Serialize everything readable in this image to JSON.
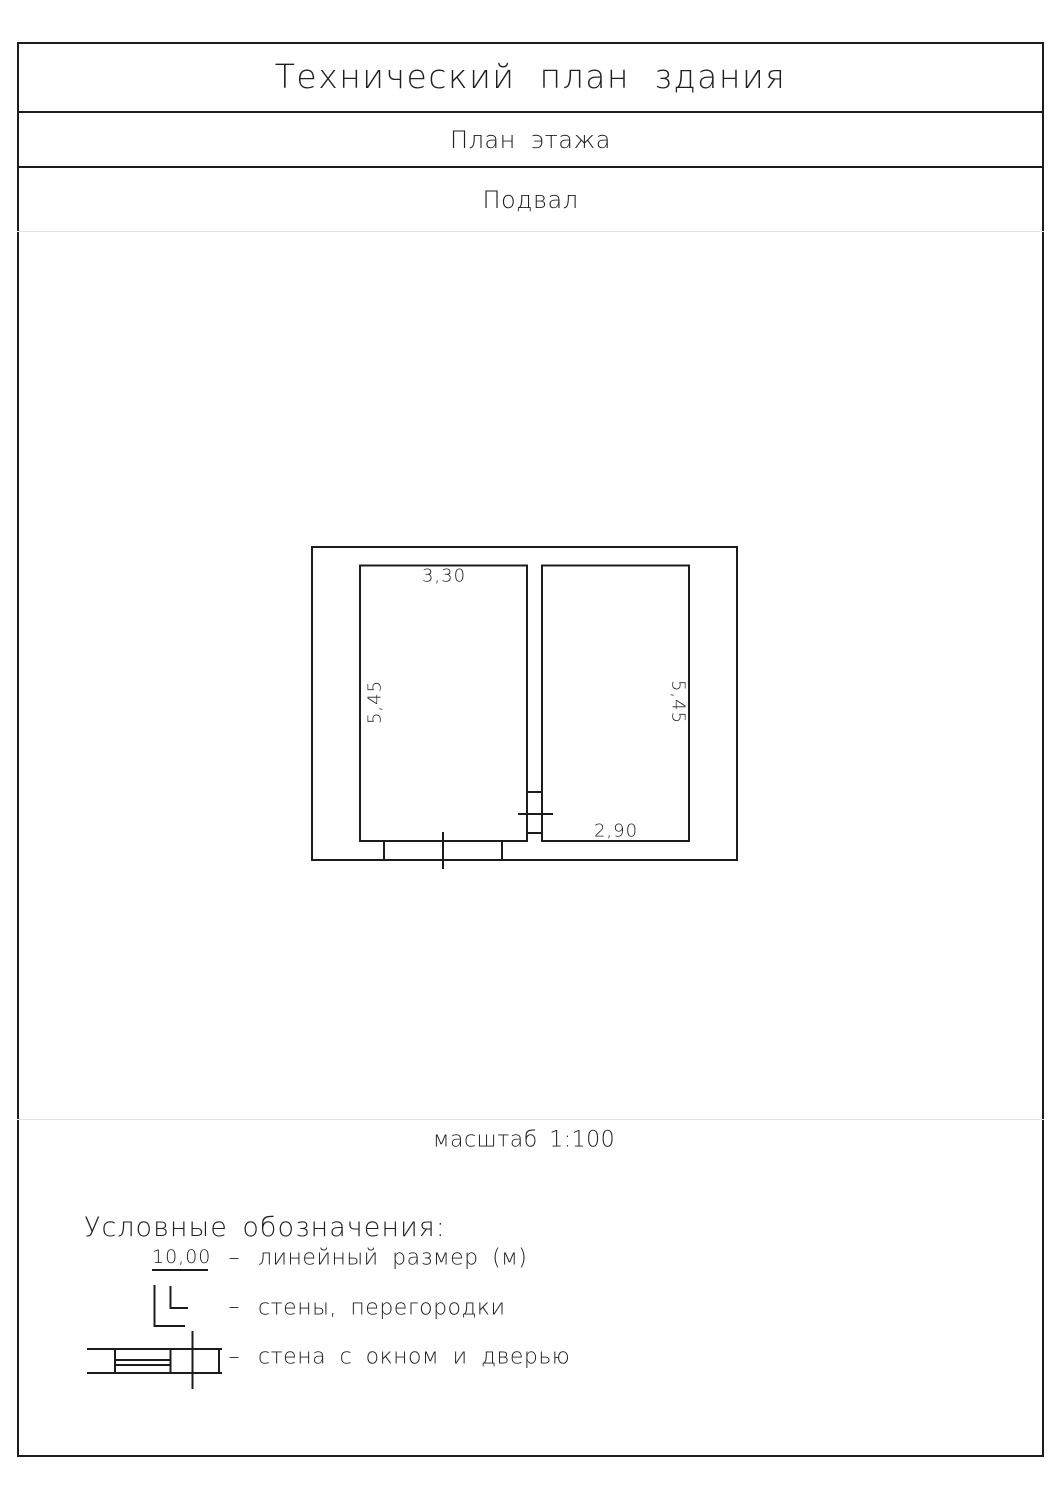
{
  "page": {
    "title": "Технический план здания",
    "subtitle": "План этажа",
    "floor_label": "Подвал",
    "scale_label": "масштаб 1:100"
  },
  "plan": {
    "dimensions": {
      "left_room_width": "3,30",
      "left_room_height": "5,45",
      "right_room_height": "5,45",
      "right_room_width": "2,90"
    }
  },
  "legend": {
    "heading": "Условные обозначения:",
    "dash": "–",
    "items": [
      {
        "symbol": "linear-dimension-sample",
        "sample": "10,00",
        "label": "линейный размер (м)"
      },
      {
        "symbol": "walls-corner",
        "label": "стены, перегородки"
      },
      {
        "symbol": "wall-window-door",
        "label": "стена с окном и дверью"
      }
    ]
  }
}
